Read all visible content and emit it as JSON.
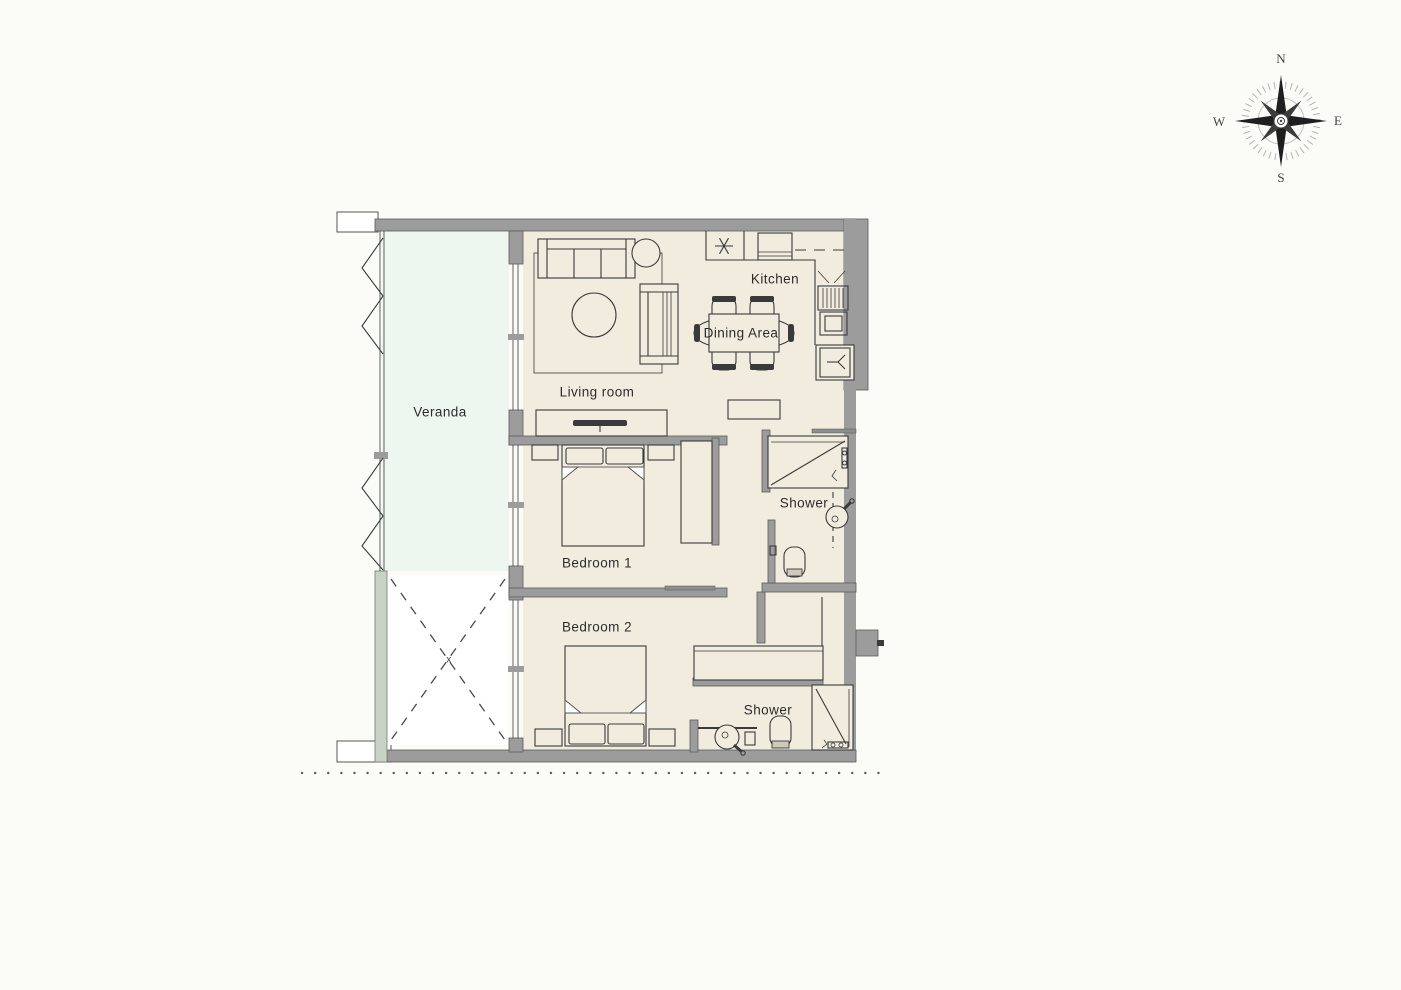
{
  "compass": {
    "north": "N",
    "east": "E",
    "south": "S",
    "west": "W"
  },
  "labels": {
    "veranda": "Veranda",
    "living_room": "Living room",
    "kitchen": "Kitchen",
    "dining_area": "Dining Area",
    "bedroom_1": "Bedroom 1",
    "bedroom_2": "Bedroom 2",
    "shower_1": "Shower",
    "shower_2": "Shower",
    "void_mark": "x"
  },
  "colors": {
    "background": "#fbfbf8",
    "wall": "#9c9c9c",
    "wall_outline": "#5a5a5a",
    "floor": "#f2ecdf",
    "veranda": "#edf7ef",
    "veranda_wall": "#c9d3c5",
    "line": "#3a3a3a"
  }
}
